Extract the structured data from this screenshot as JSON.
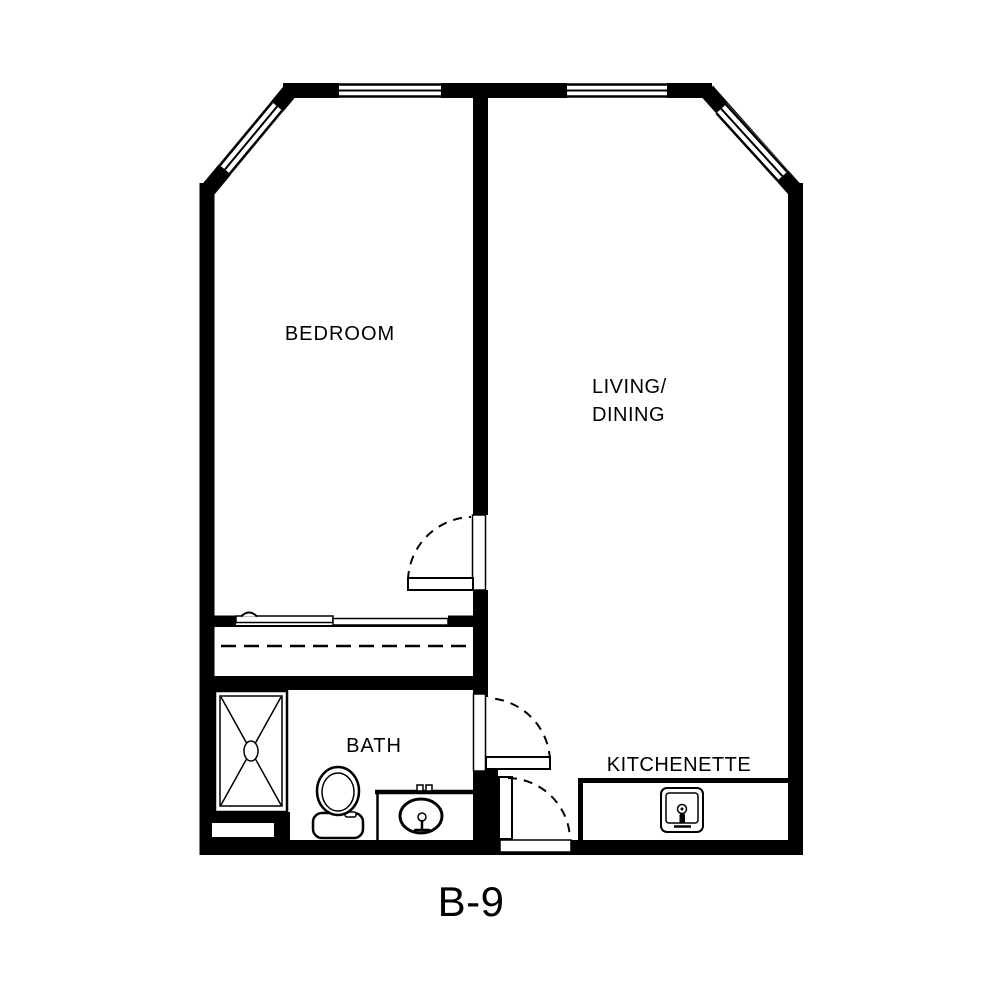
{
  "plan": {
    "code": "B-9",
    "rooms": {
      "bedroom": "BEDROOM",
      "living_line1": "LIVING/",
      "living_line2": "DINING",
      "bath": "BATH",
      "kitchenette": "KITCHENETTE"
    },
    "colors": {
      "line": "#000000",
      "background": "#ffffff"
    },
    "features": {
      "windows": [
        "top-wall-window-left",
        "top-wall-window-right",
        "corner-window-left",
        "corner-window-right"
      ],
      "doors": [
        "bedroom-door",
        "bath-door",
        "entry-door"
      ],
      "fixtures": [
        "shower",
        "toilet",
        "vanity-sink",
        "kitchen-sink",
        "closet-with-sliding-doors"
      ]
    }
  }
}
